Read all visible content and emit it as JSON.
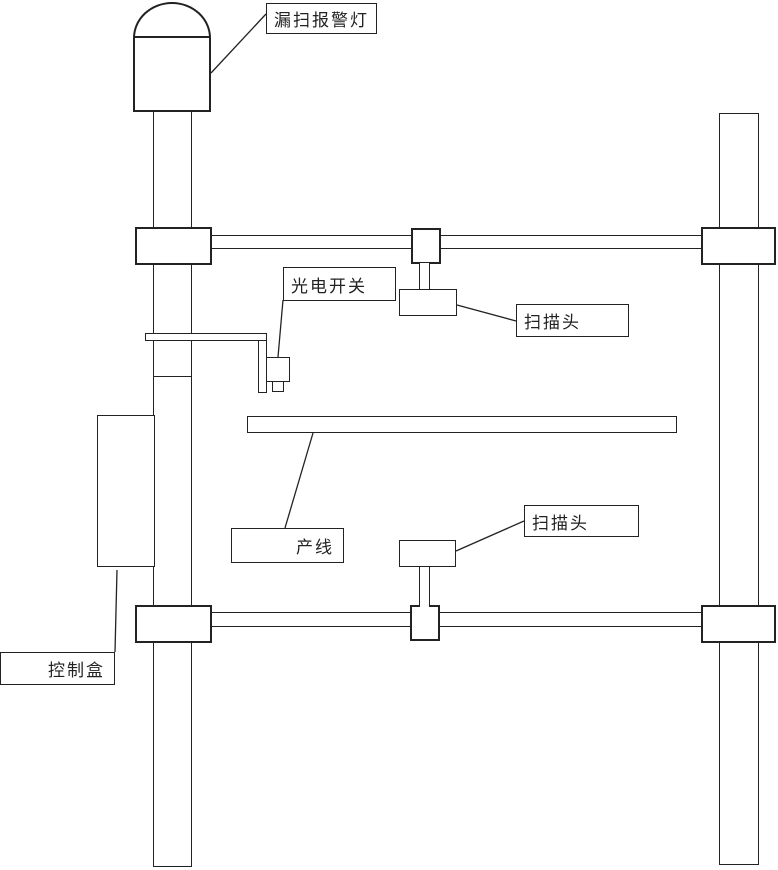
{
  "labels": {
    "alarm_light": "漏扫报警灯",
    "photoelectric_switch": "光电开关",
    "scan_head_top": "扫描头",
    "scan_head_bottom": "扫描头",
    "production_line": "产线",
    "control_box": "控制盒"
  },
  "colors": {
    "line": "#222222",
    "background": "#ffffff"
  }
}
